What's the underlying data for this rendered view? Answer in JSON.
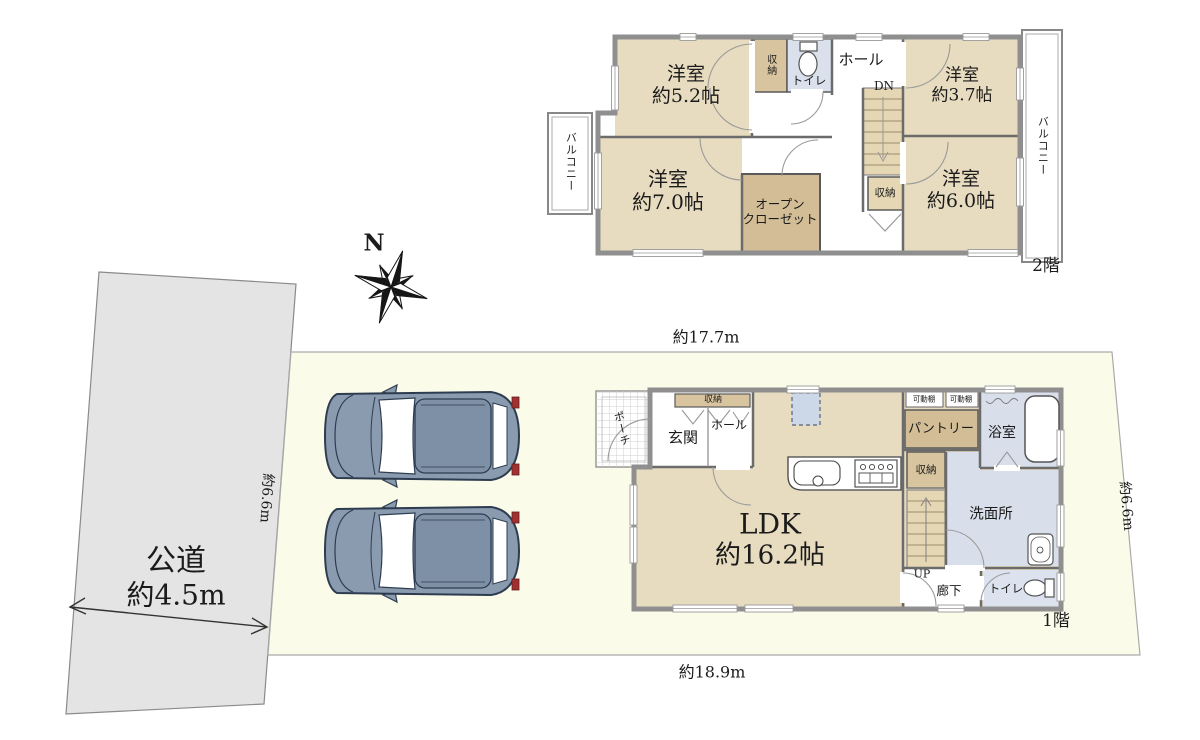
{
  "colors": {
    "site_fill": "#FBFBE9",
    "road_fill": "#E4E4E4",
    "room_tan": "#E8DCC0",
    "closet_tan": "#D2BD96",
    "storage_tan": "#D8C49E",
    "stairs_tan": "#E5D7B4",
    "wet_area_blue": "#D8DFEB",
    "wall_gray": "#8F8F8F",
    "car_body": "#8A9BB0",
    "tail_light_red": "#A33030"
  },
  "site": {
    "dim_top": "約17.7m",
    "dim_bottom": "約18.9m",
    "dim_right": "約6.6m",
    "road_depth_dim": "約6.6m",
    "road_line1": "公道",
    "road_line2": "約4.5m",
    "compass_north": "N"
  },
  "floor2": {
    "label": "2階",
    "room_5_2": {
      "line1": "洋室",
      "line2": "約5.2帖"
    },
    "room_3_7": {
      "line1": "洋室",
      "line2": "約3.7帖"
    },
    "room_7_0": {
      "line1": "洋室",
      "line2": "約7.0帖"
    },
    "room_6_0": {
      "line1": "洋室",
      "line2": "約6.0帖"
    },
    "open_closet": {
      "line1": "オープン",
      "line2": "クローゼット"
    },
    "hall": "ホール",
    "dn": "DN",
    "toilet": "トイレ",
    "storage_top": "収納",
    "storage_stairs": "収納",
    "balcony_left": "バルコニー",
    "balcony_right": "バルコニー"
  },
  "floor1": {
    "label": "1階",
    "ldk": {
      "line1": "LDK",
      "line2": "約16.2帖"
    },
    "porch": "ポーチ",
    "entrance": "玄関",
    "hall": "ホール",
    "storage_entrance": "収納",
    "shelf_left": "可動棚",
    "shelf_right": "可動棚",
    "pantry": "パントリー",
    "bath": "浴室",
    "storage_mid": "収納",
    "washroom": "洗面所",
    "up": "UP",
    "corridor": "廊下",
    "toilet": "トイレ"
  }
}
